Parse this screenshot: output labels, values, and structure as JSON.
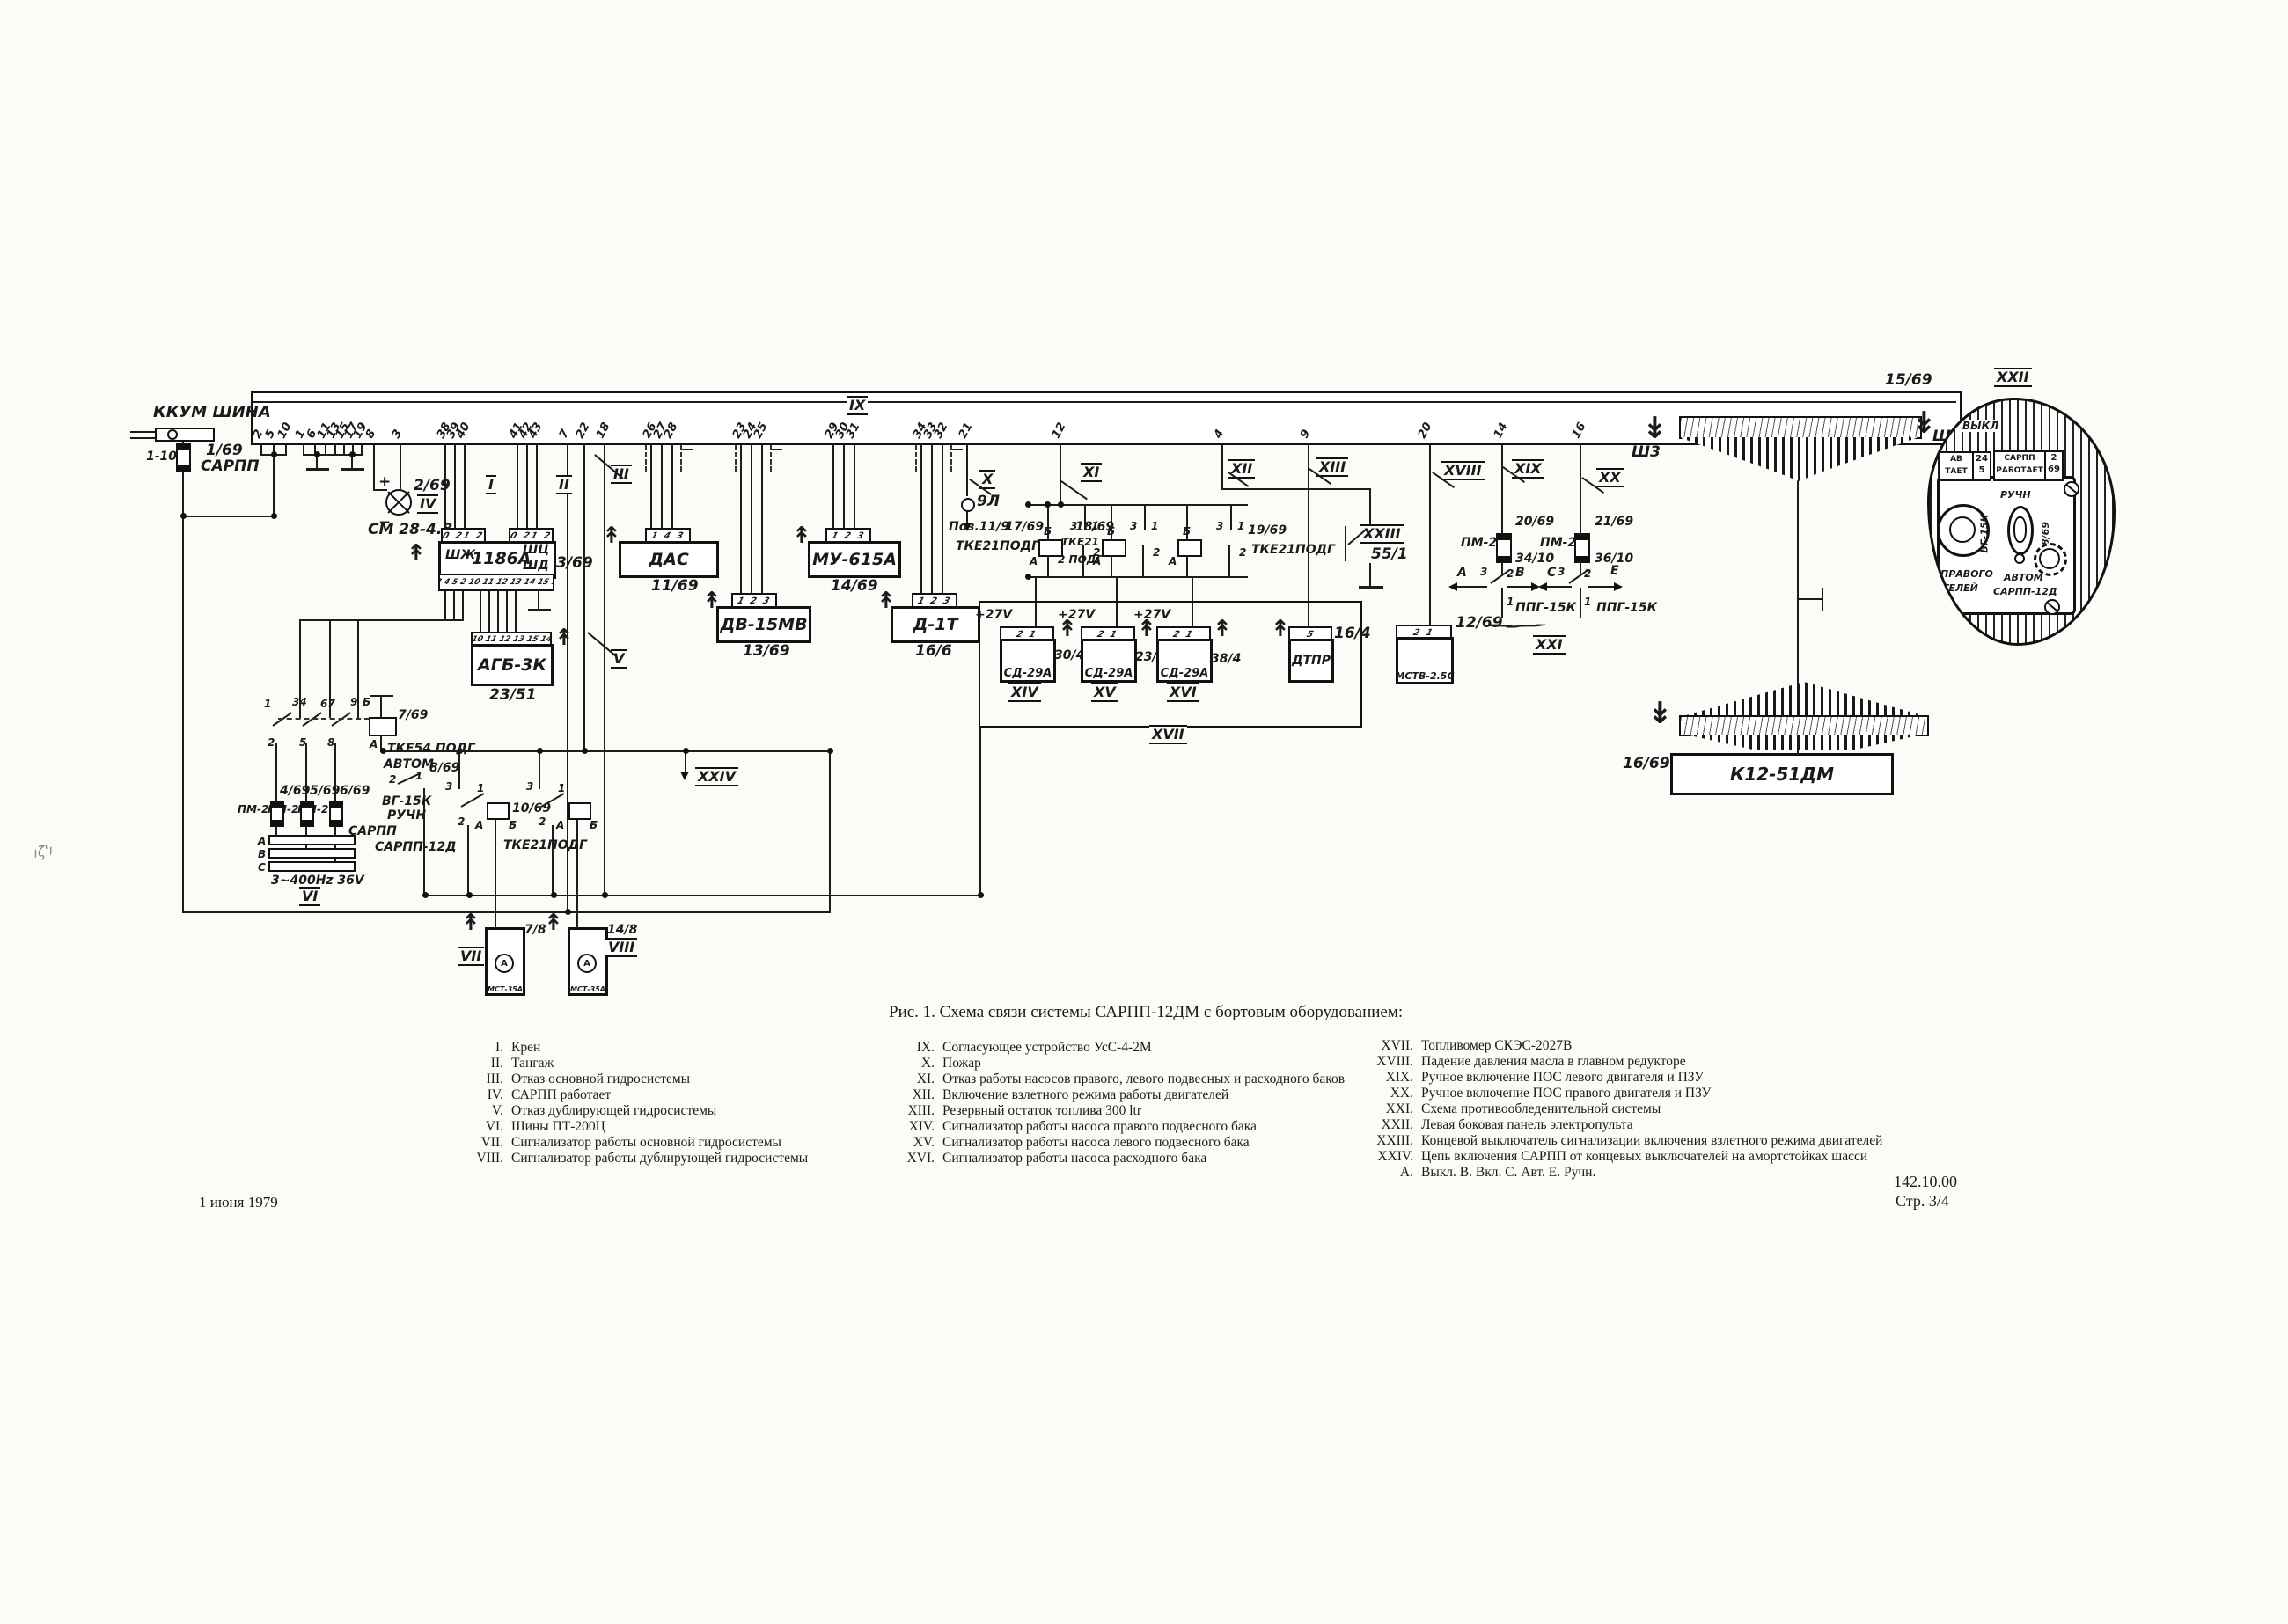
{
  "doc": {
    "caption": "Рис. 1. Схема связи системы САРПП-12ДМ с бортовым оборудованием:",
    "date": "1 июня 1979",
    "code": "142.10.00",
    "page": "Стр. 3/4"
  },
  "legend": {
    "col1": [
      {
        "n": "I.",
        "t": "Крен"
      },
      {
        "n": "II.",
        "t": "Тангаж"
      },
      {
        "n": "III.",
        "t": "Отказ основной гидросистемы"
      },
      {
        "n": "IV.",
        "t": "САРПП работает"
      },
      {
        "n": "V.",
        "t": "Отказ дублирующей гидросистемы"
      },
      {
        "n": "VI.",
        "t": "Шины ПТ-200Ц"
      },
      {
        "n": "VII.",
        "t": "Сигнализатор работы основной гидросистемы"
      },
      {
        "n": "VIII.",
        "t": "Сигнализатор работы дублирующей гидросистемы"
      }
    ],
    "col2": [
      {
        "n": "IX.",
        "t": "Согласующее устройство УсС-4-2М"
      },
      {
        "n": "X.",
        "t": "Пожар"
      },
      {
        "n": "XI.",
        "t": "Отказ работы насосов правого, левого подвесных  и расходного баков"
      },
      {
        "n": "XII.",
        "t": "Включение взлетного режима работы двигателей"
      },
      {
        "n": "XIII.",
        "t": "Резервный остаток топлива 300 ltr"
      },
      {
        "n": "XIV.",
        "t": "Сигнализатор работы насоса правого подвесного бака"
      },
      {
        "n": "XV.",
        "t": "Сигнализатор работы насоса левого подвесного бака"
      },
      {
        "n": "XVI.",
        "t": "Сигнализатор работы насоса расходного бака"
      }
    ],
    "col3": [
      {
        "n": "XVII.",
        "t": "Топливомер СКЭС-2027В"
      },
      {
        "n": "XVIII.",
        "t": "Падение давления масла в главном редукторе"
      },
      {
        "n": "XIX.",
        "t": "Ручное включение ПОС левого двигателя и ПЗУ"
      },
      {
        "n": "XX.",
        "t": "Ручное включение ПОС правого двигателя и ПЗУ"
      },
      {
        "n": "XXI.",
        "t": "Схема противообледенительной системы"
      },
      {
        "n": "XXII.",
        "t": "Левая боковая панель электропульта"
      },
      {
        "n": "XXIII.",
        "t": "Концевой выключатель сигнализации включения взлетного режима двигателей"
      },
      {
        "n": "XXIV.",
        "t": "Цепь включения САРПП от концевых выключателей на амортстойках шасси"
      },
      {
        "n": "А.",
        "t": "Выкл.  В.  Вкл.  С.  Авт.  Е.  Ручн."
      }
    ]
  },
  "bus": {
    "pins": [
      "2",
      "5",
      "10",
      "1",
      "6",
      "11",
      "13",
      "15",
      "17",
      "19",
      "8",
      "3",
      "38",
      "39",
      "40",
      "41",
      "42",
      "43",
      "7",
      "22",
      "18",
      "26",
      "27",
      "28",
      "23",
      "24",
      "25",
      "29",
      "30",
      "31",
      "34",
      "33",
      "32",
      "21",
      "12",
      "4",
      "9",
      "20",
      "14",
      "16"
    ]
  },
  "tags": {
    "t1": "I",
    "t2": "II",
    "t3": "III",
    "t4": "IV",
    "t5": "V",
    "t6": "VI",
    "t7": "VII",
    "t8": "VIII",
    "t9": "IX",
    "t10": "X",
    "t11": "XI",
    "t12": "XII",
    "t13": "XIII",
    "t14": "XIV",
    "t15": "XV",
    "t16": "XVI",
    "t17": "XVII",
    "t18": "XVIII",
    "t19": "XIX",
    "t20": "XX",
    "t21": "XXI",
    "t22": "XXII",
    "t23": "XXIII",
    "t24": "XXIV"
  },
  "labels": {
    "kkum": "ККУМ ШИНА",
    "f110": "1-10",
    "f169": "1/69",
    "sarpp_small": "САРПП",
    "plus": "+",
    "minus": "−",
    "lamp_ref": "2/69",
    "lamp_name": "СМ 28-4.8",
    "shj": "ШЖ",
    "b1186": "1186А",
    "shc": "ШЦ",
    "shd": "ШД",
    "r3_69": "3/69",
    "pins1186t": "20 21 23",
    "pins1186b": "3 4 5 2 10 11 12 13 14 15 1",
    "agb": "АГБ-3К",
    "agb_ref": "23/51",
    "agb_pins": "10 11 12 13 15 14",
    "das": "ДАС",
    "das_ref": "11/69",
    "das_pins": "1 4 3",
    "dv": "ДВ-15МВ",
    "dv_ref": "13/69",
    "p123": "1 2 3",
    "mu": "МУ-615А",
    "mu_ref": "14/69",
    "d1t": "Д-1Т",
    "d1t_ref": "16/6",
    "l9": "9Л",
    "poz": "Поз.11/9",
    "r17": "17/69",
    "tke21podg": "ТКЕ21ПОДГ",
    "r18": "18/69",
    "tke21": "ТКЕ21",
    "podg2": "2 ПОДГ",
    "r19": "19/69",
    "n1": "1",
    "n2": "2",
    "n3": "3",
    "n5": "5",
    "a": "А",
    "b": "Б",
    "v27": "+27V",
    "sd": "СД-29А",
    "sd1_ref": "30/4",
    "sd2_ref": "23/4",
    "sd3_ref": "38/4",
    "dtpr": "ДТПР",
    "dtpr_ref": "16/4",
    "mstv": "МСТВ-2.5С",
    "mstv_ref": "12/69",
    "p21": "2 1",
    "sw551": "55/1",
    "pm2": "ПМ-2",
    "r20": "20/69",
    "r21": "21/69",
    "sw34": "34/10",
    "sw36": "36/10",
    "ppg": "ППГ-15К",
    "la": "А",
    "lv": "В",
    "lc": "С",
    "le": "Е",
    "sh3": "Ш3",
    "sh2": "Ш2",
    "r15_69": "15/69",
    "k12": "К12-51ДМ",
    "k12_ref": "16/69",
    "tke54": "ТКЕ54 ПОДГ",
    "r7_69": "7/69",
    "p34": "34",
    "p67": "67",
    "p9": "9",
    "p5": "5",
    "p8": "8",
    "avtom": "АВТОМ",
    "r8_69": "8/69",
    "vg15": "ВГ-15К",
    "ruchn": "РУЧН",
    "sarpp12": "САРПП-12Д",
    "f4": "4/69",
    "f5": "5/69",
    "f6": "6/69",
    "ph_a": "А",
    "ph_b": "В",
    "ph_c": "С",
    "ph": "3~400Hz 36V",
    "r10": "10/69",
    "mst": "МСТ-35А",
    "mst1_ref": "7/8",
    "mst2_ref": "14/8",
    "mst_sym": "А"
  },
  "panel": {
    "vykl": "ВЫКЛ",
    "ind1_l1": "АВ",
    "ind1_l2": "ТАЕТ",
    "ind1_n1": "24",
    "ind1_n2": "5",
    "ind2_l1": "САРПП",
    "ind2_l2": "РАБОТАЕТ",
    "ind2_n1": "2",
    "ind2_n2": "69",
    "ruchn": "РУЧН",
    "vg": "ВГ-15К",
    "ref": "8/69",
    "avtom": "АВТОМ",
    "sarpp": "САРПП-12Д",
    "txt1": "ПРАВОГО",
    "txt2": "ТЕЛЕЙ"
  }
}
